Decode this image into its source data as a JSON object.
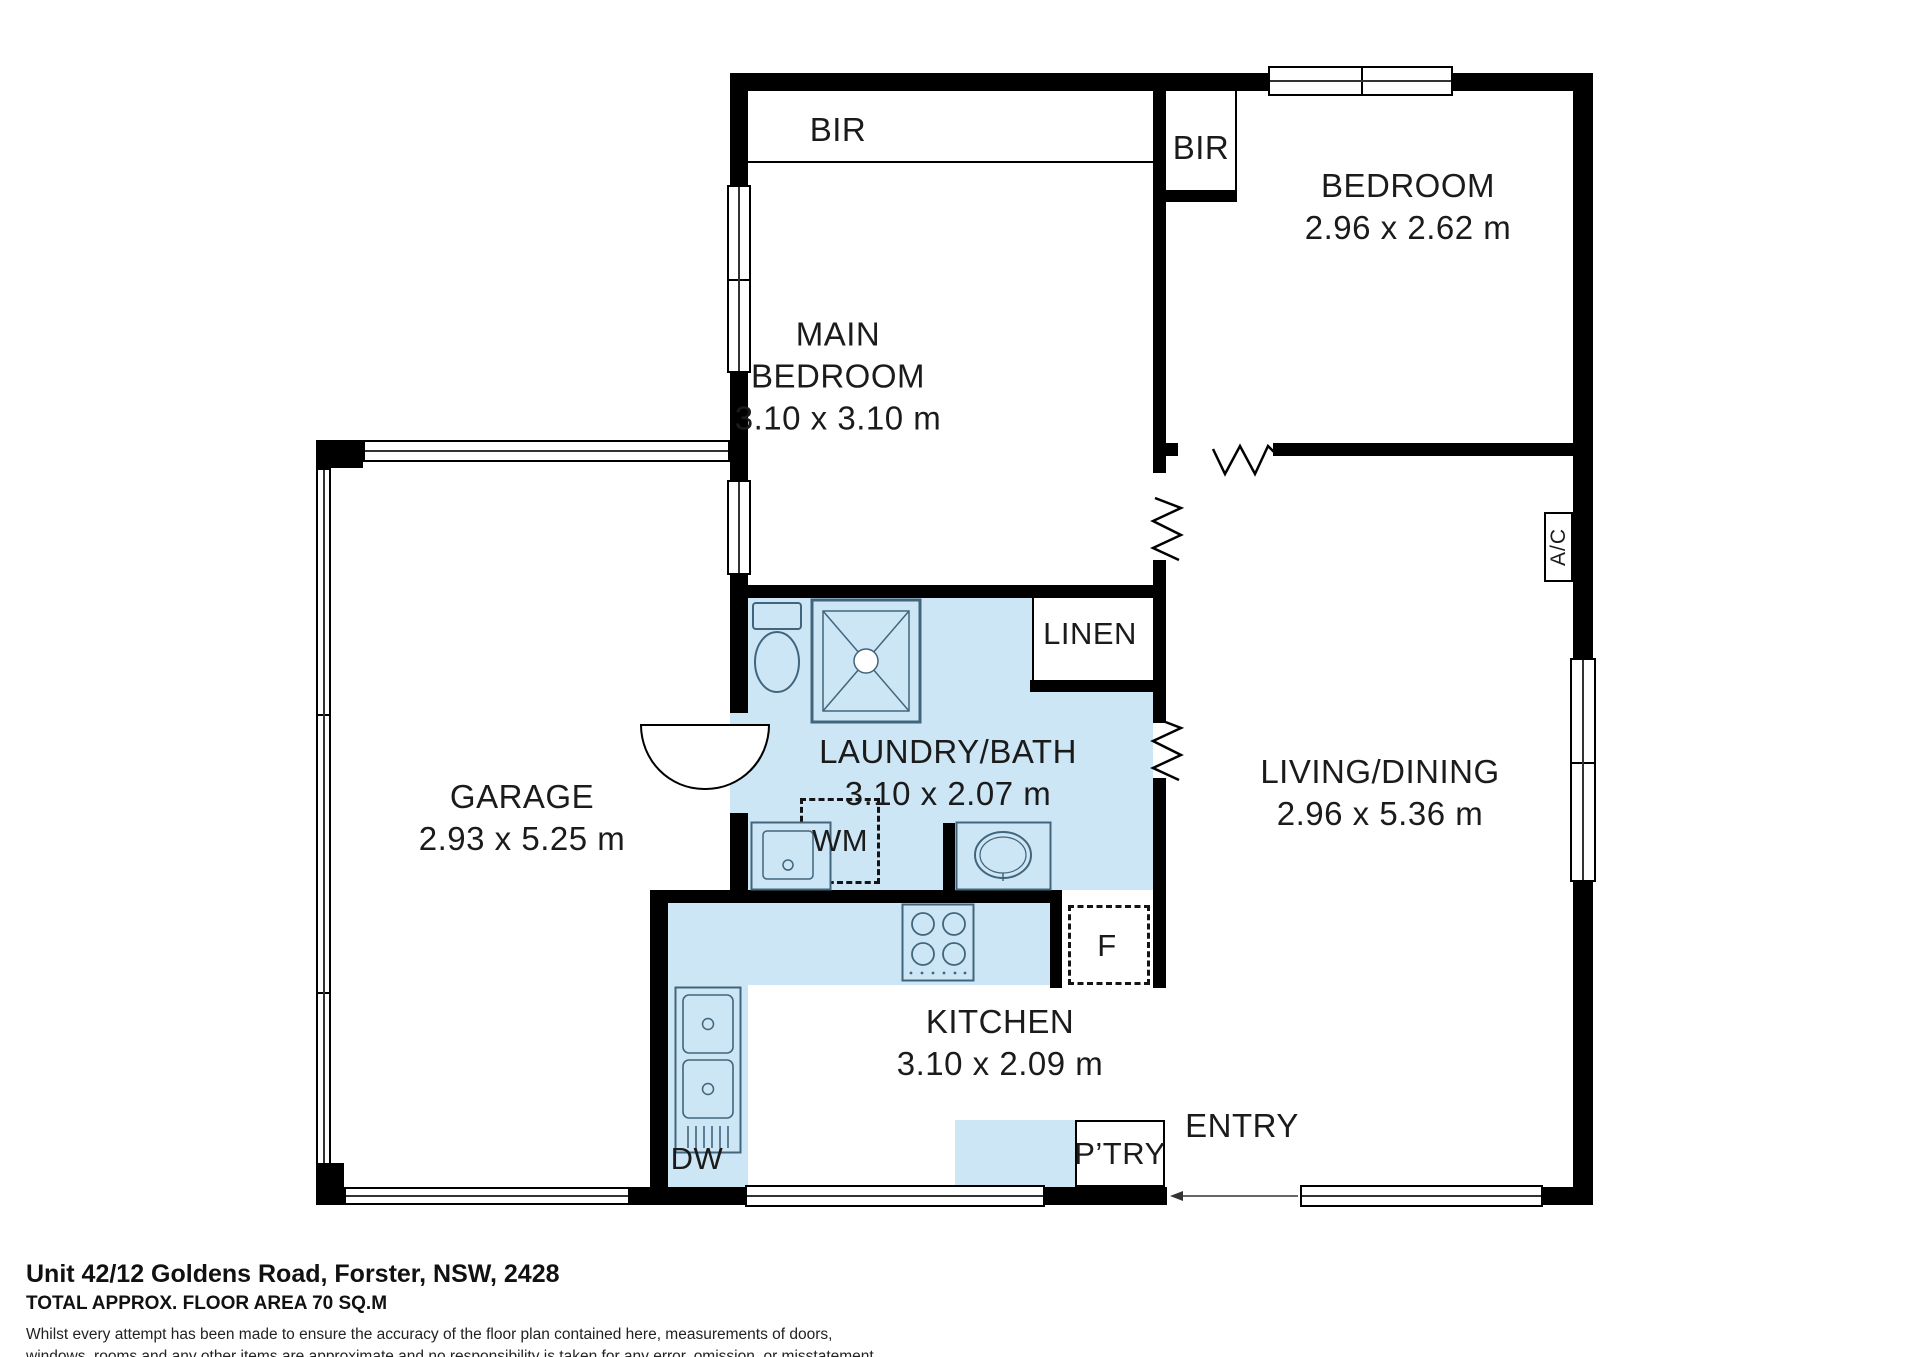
{
  "rooms": {
    "main_bedroom": {
      "line1": "MAIN",
      "line2": "BEDROOM",
      "dims": "3.10 x 3.10 m"
    },
    "bedroom": {
      "name": "BEDROOM",
      "dims": "2.96 x 2.62 m"
    },
    "living_dining": {
      "name": "LIVING/DINING",
      "dims": "2.96 x 5.36 m"
    },
    "laundry_bath": {
      "name": "LAUNDRY/BATH",
      "dims": "3.10 x 2.07 m"
    },
    "kitchen": {
      "name": "KITCHEN",
      "dims": "3.10 x 2.09 m"
    },
    "garage": {
      "name": "GARAGE",
      "dims": "2.93 x 5.25 m"
    },
    "entry": "ENTRY"
  },
  "fixtures": {
    "bir_main": "BIR",
    "bir_bedroom": "BIR",
    "linen": "LINEN",
    "washing_machine": "WM",
    "dishwasher": "DW",
    "fridge": "F",
    "pantry": "P’TRY",
    "air_conditioner": "A/C"
  },
  "footer": {
    "address": "Unit 42/12 Goldens Road, Forster, NSW, 2428",
    "area": "TOTAL APPROX. FLOOR AREA 70 SQ.M",
    "disclaimer_1": "Whilst every attempt has been made to ensure the accuracy of the floor plan contained here, measurements of doors,",
    "disclaimer_2": "windows, rooms and any other items are approximate and no responsibility is taken for any error, omission, or misstatement.",
    "disclaimer_3": "This plan is for illustrative purposes only and should be used as such by any prospective purchaser."
  },
  "colors": {
    "wall": "#000000",
    "wet_area_fill": "#cde6f5",
    "fixture_outline": "#41657c"
  }
}
